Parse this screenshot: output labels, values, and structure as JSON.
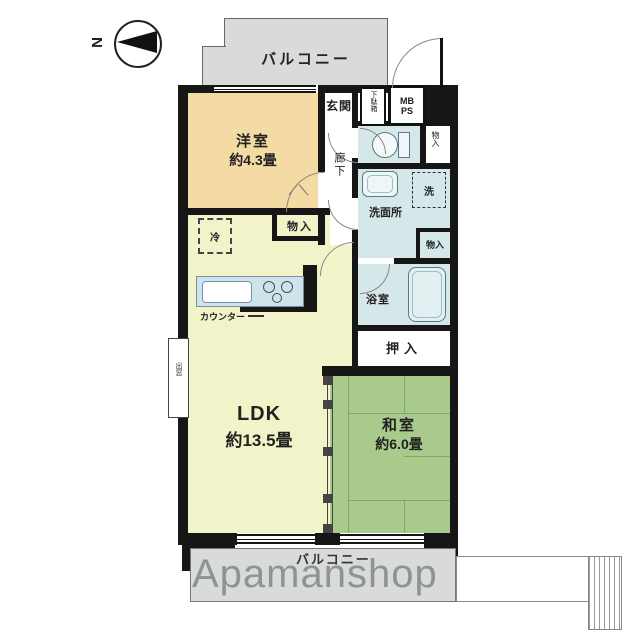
{
  "compass": {
    "north": "N"
  },
  "balconies": {
    "top": "バルコニー",
    "bottom": "バルコニー"
  },
  "rooms": {
    "yoshitsu": {
      "name": "洋室",
      "size": "約4.3畳"
    },
    "ldk": {
      "name": "LDK",
      "size": "約13.5畳"
    },
    "washitsu": {
      "name": "和室",
      "size": "約6.0畳"
    },
    "genkan": "玄関",
    "rouka": "廊下",
    "senmenjo": "洗面所",
    "yokushitsu": "浴室",
    "oshiire": "押入"
  },
  "storage": {
    "getabako": "下駄箱",
    "hall_closet": "物入",
    "yoshitsu_closet": "物入",
    "senmen_closet": "物入"
  },
  "fixtures": {
    "mb": "MB",
    "ps": "PS",
    "refrigerator": "冷",
    "washer": "洗",
    "counter": "カウンター",
    "bay_window": "出窓"
  },
  "watermark": "Apamanshop",
  "colors": {
    "wall": "#161616",
    "yoshitsu": "#f4dba3",
    "ldk": "#f2f3c9",
    "washitsu": "#a9ca8d",
    "wet_area": "#d6e7e9",
    "balcony": "#d9dbd9",
    "tatami_line": "#7fa863",
    "watermark": "#8c9093"
  }
}
